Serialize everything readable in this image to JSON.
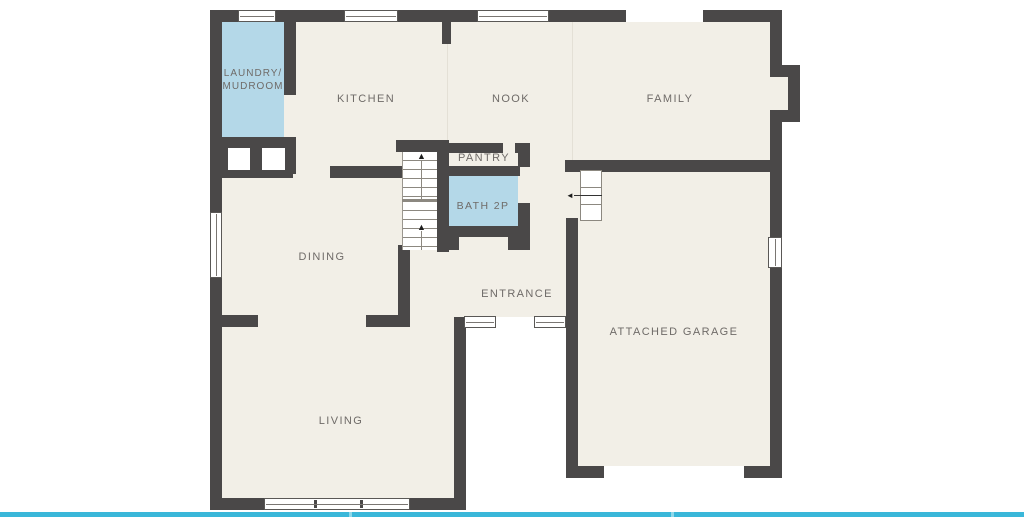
{
  "rooms": {
    "laundry_line1": "LAUNDRY/",
    "laundry_line2": "MUDROOM",
    "kitchen": "KITCHEN",
    "nook": "NOOK",
    "family": "FAMILY",
    "pantry": "PANTRY",
    "bath": "BATH 2P",
    "dining": "DINING",
    "entrance": "ENTRANCE",
    "garage": "ATTACHED GARAGE",
    "living": "LIVING"
  },
  "icons": {
    "stairs_up_arrow": "▲",
    "garage_step_arrow": "◄"
  },
  "colors": {
    "wall": "#4a4848",
    "floor": "#f2efe7",
    "highlight_room": "#b4d8e8",
    "label_text": "#6f6b68",
    "carousel_bar": "#3ab7d9",
    "carousel_tick": "#8ed8ea",
    "background": "#ffffff"
  }
}
